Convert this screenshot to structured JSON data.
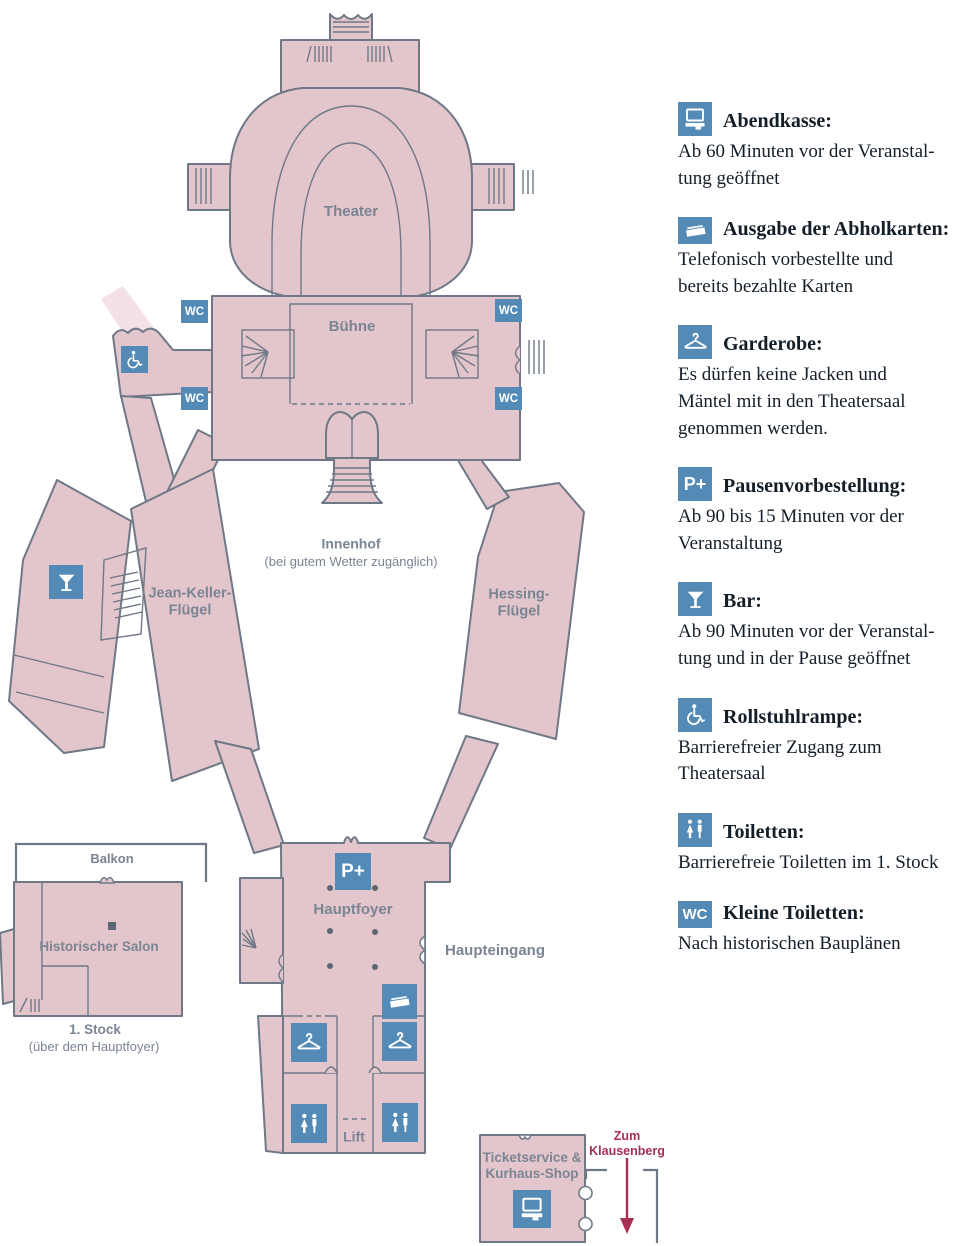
{
  "colors": {
    "building": "#e3c6cb",
    "ramp": "#f3e1e6",
    "outline": "#6e7887",
    "icon": "#548ab6",
    "maplabel": "#7b8493",
    "text": "#141e28",
    "red": "#a82f52",
    "dot": "#5d6673"
  },
  "map": {
    "labels": {
      "theater": "Theater",
      "buehne": "Bühne",
      "innenhof_title": "Innenhof",
      "innenhof_sub": "(bei gutem Wetter zugänglich)",
      "jean_keller": [
        "Jean-Keller-",
        "Flügel"
      ],
      "hessing": [
        "Hessing-",
        "Flügel"
      ],
      "hauptfoyer": "Hauptfoyer",
      "haupteingang": "Haupteingang",
      "balkon": "Balkon",
      "salon": "Historischer Salon",
      "stock_title": "1. Stock",
      "stock_sub": "(über dem Hauptfoyer)",
      "lift": "Lift",
      "shop": [
        "Ticketservice &",
        "Kurhaus-Shop"
      ],
      "klausenberg": [
        "Zum",
        "Klausenberg"
      ]
    },
    "icon_labels": {
      "wc": "WC",
      "p_plus": "P+"
    }
  },
  "legend": {
    "items": [
      {
        "icon": "cash-register-icon",
        "title": "Abendkasse:",
        "body": [
          "Ab 60 Minuten vor der Veranstal-",
          "tung geöffnet"
        ]
      },
      {
        "icon": "tickets-icon",
        "title": "Ausgabe der Abholkarten:",
        "body": [
          "Telefonisch vorbestellte und",
          "bereits bezahlte Karten"
        ]
      },
      {
        "icon": "hanger-icon",
        "title": "Garderobe:",
        "body": [
          "Es dürfen keine Jacken und",
          "Mäntel mit in den Theatersaal",
          "genommen werden."
        ]
      },
      {
        "icon": "p-plus-icon",
        "title": "Pausenvorbestellung:",
        "body": [
          "Ab 90 bis 15 Minuten vor der",
          "Veranstaltung"
        ]
      },
      {
        "icon": "bar-icon",
        "title": "Bar:",
        "body": [
          "Ab 90 Minuten vor der Veranstal-",
          "tung und in der Pause geöffnet"
        ]
      },
      {
        "icon": "wheelchair-icon",
        "title": "Rollstuhlrampe:",
        "body": [
          "Barrierefreier Zugang zum",
          "Theatersaal"
        ]
      },
      {
        "icon": "toilets-icon",
        "title": "Toiletten:",
        "body": [
          "Barrierefreie Toiletten im 1. Stock"
        ]
      },
      {
        "icon": "wc-icon",
        "title": "Kleine Toiletten:",
        "body": [
          "Nach historischen Bauplänen"
        ]
      }
    ]
  }
}
